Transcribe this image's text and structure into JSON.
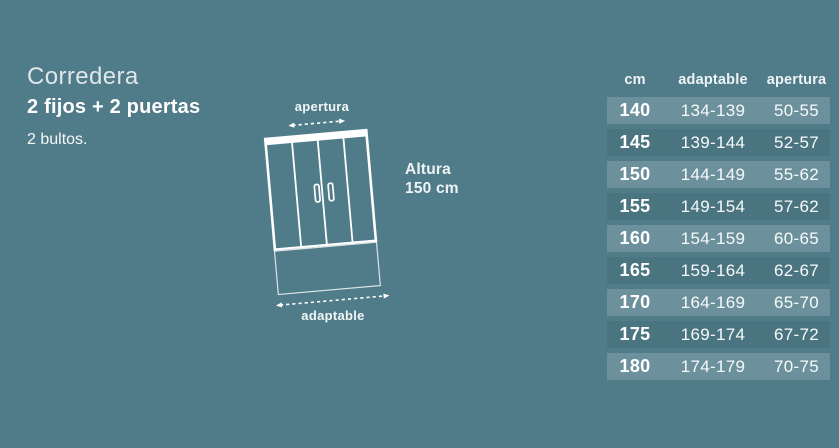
{
  "theme": {
    "background": "#507b88",
    "row_highlight": "rgba(255,255,255,0.17)",
    "line_color": "#ffffff"
  },
  "product": {
    "title": "Corredera",
    "subtitle": "2 fijos + 2 puertas",
    "packages": "2 bultos."
  },
  "diagram": {
    "opening_label": "apertura",
    "adaptable_label": "adaptable",
    "height_label": "Altura",
    "height_value": "150 cm"
  },
  "size_table": {
    "columns": [
      "cm",
      "adaptable",
      "apertura"
    ],
    "rows": [
      [
        "140",
        "134-139",
        "50-55"
      ],
      [
        "145",
        "139-144",
        "52-57"
      ],
      [
        "150",
        "144-149",
        "55-62"
      ],
      [
        "155",
        "149-154",
        "57-62"
      ],
      [
        "160",
        "154-159",
        "60-65"
      ],
      [
        "165",
        "159-164",
        "62-67"
      ],
      [
        "170",
        "164-169",
        "65-70"
      ],
      [
        "175",
        "169-174",
        "67-72"
      ],
      [
        "180",
        "174-179",
        "70-75"
      ]
    ]
  }
}
